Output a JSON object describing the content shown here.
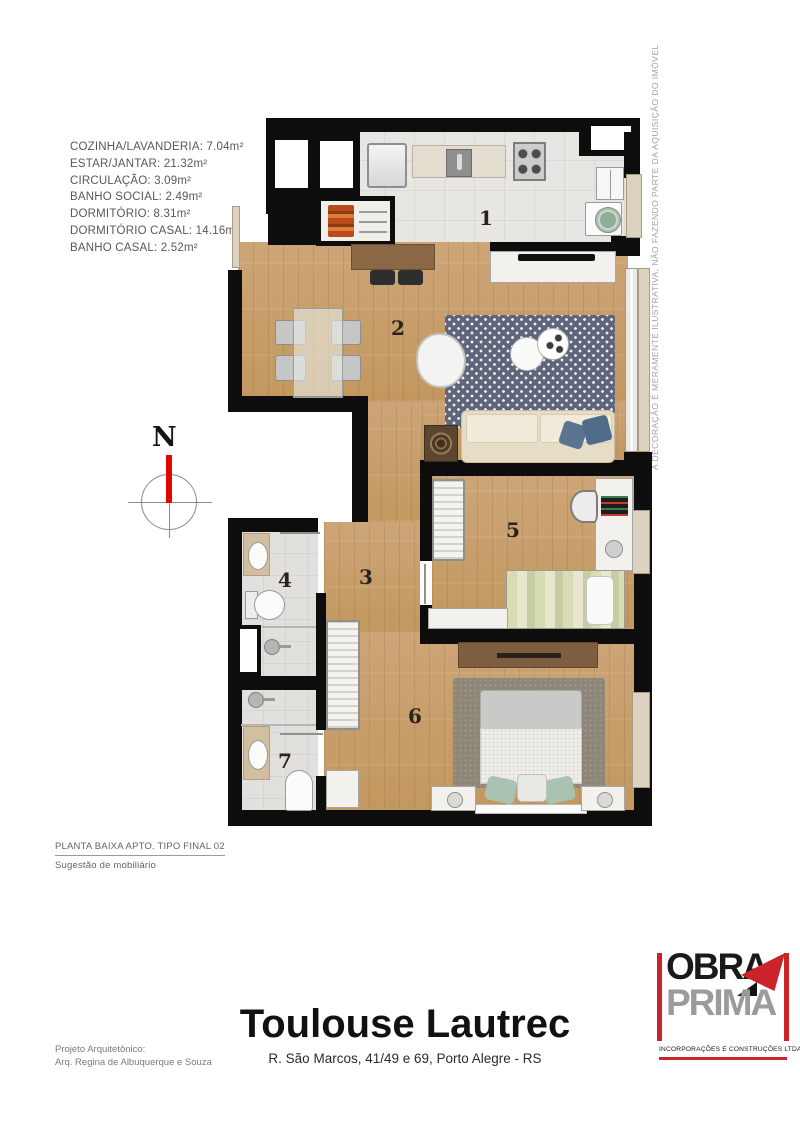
{
  "legend": {
    "items": [
      "COZINHA/LAVANDERIA: 7.04m²",
      "ESTAR/JANTAR: 21.32m²",
      "CIRCULAÇÃO: 3.09m²",
      "BANHO SOCIAL: 2.49m²",
      "DORMITÓRIO: 8.31m²",
      "DORMITÓRIO CASAL: 14.16m²",
      "BANHO CASAL: 2.52m²"
    ]
  },
  "plan": {
    "doc_title": "PLANTA BAIXA APTO. TIPO FINAL 02",
    "doc_subtitle": "Sugestão de mobiliário",
    "north_label": "N",
    "disclaimer": "A DECORAÇÃO É MERAMENTE ILUSTRATIVA, NÃO FAZENDO PARTE DA AQUISIÇÃO DO IMÓVEL",
    "room_labels": [
      "1",
      "2",
      "3",
      "4",
      "5",
      "6",
      "7"
    ]
  },
  "footer": {
    "architect_label": "Projeto Arquitetônico:",
    "architect_name": "Arq. Regina de Albuquerque e Souza",
    "building_name": "Toulouse Lautrec",
    "address": "R. São Marcos, 41/49 e 69, Porto Alegre - RS"
  },
  "logo": {
    "word1": "OBRA",
    "word2": "PRIMA",
    "tagline": "INCORPORAÇÕES E CONSTRUÇÕES LTDA"
  },
  "colors": {
    "accent_red": "#cc2229",
    "logo_gray": "#9b9b9d",
    "wall_black": "#0d0d0d",
    "wood": "#c79f70",
    "tile": "#e8e6e2",
    "rug_navy": "#5f657b"
  }
}
